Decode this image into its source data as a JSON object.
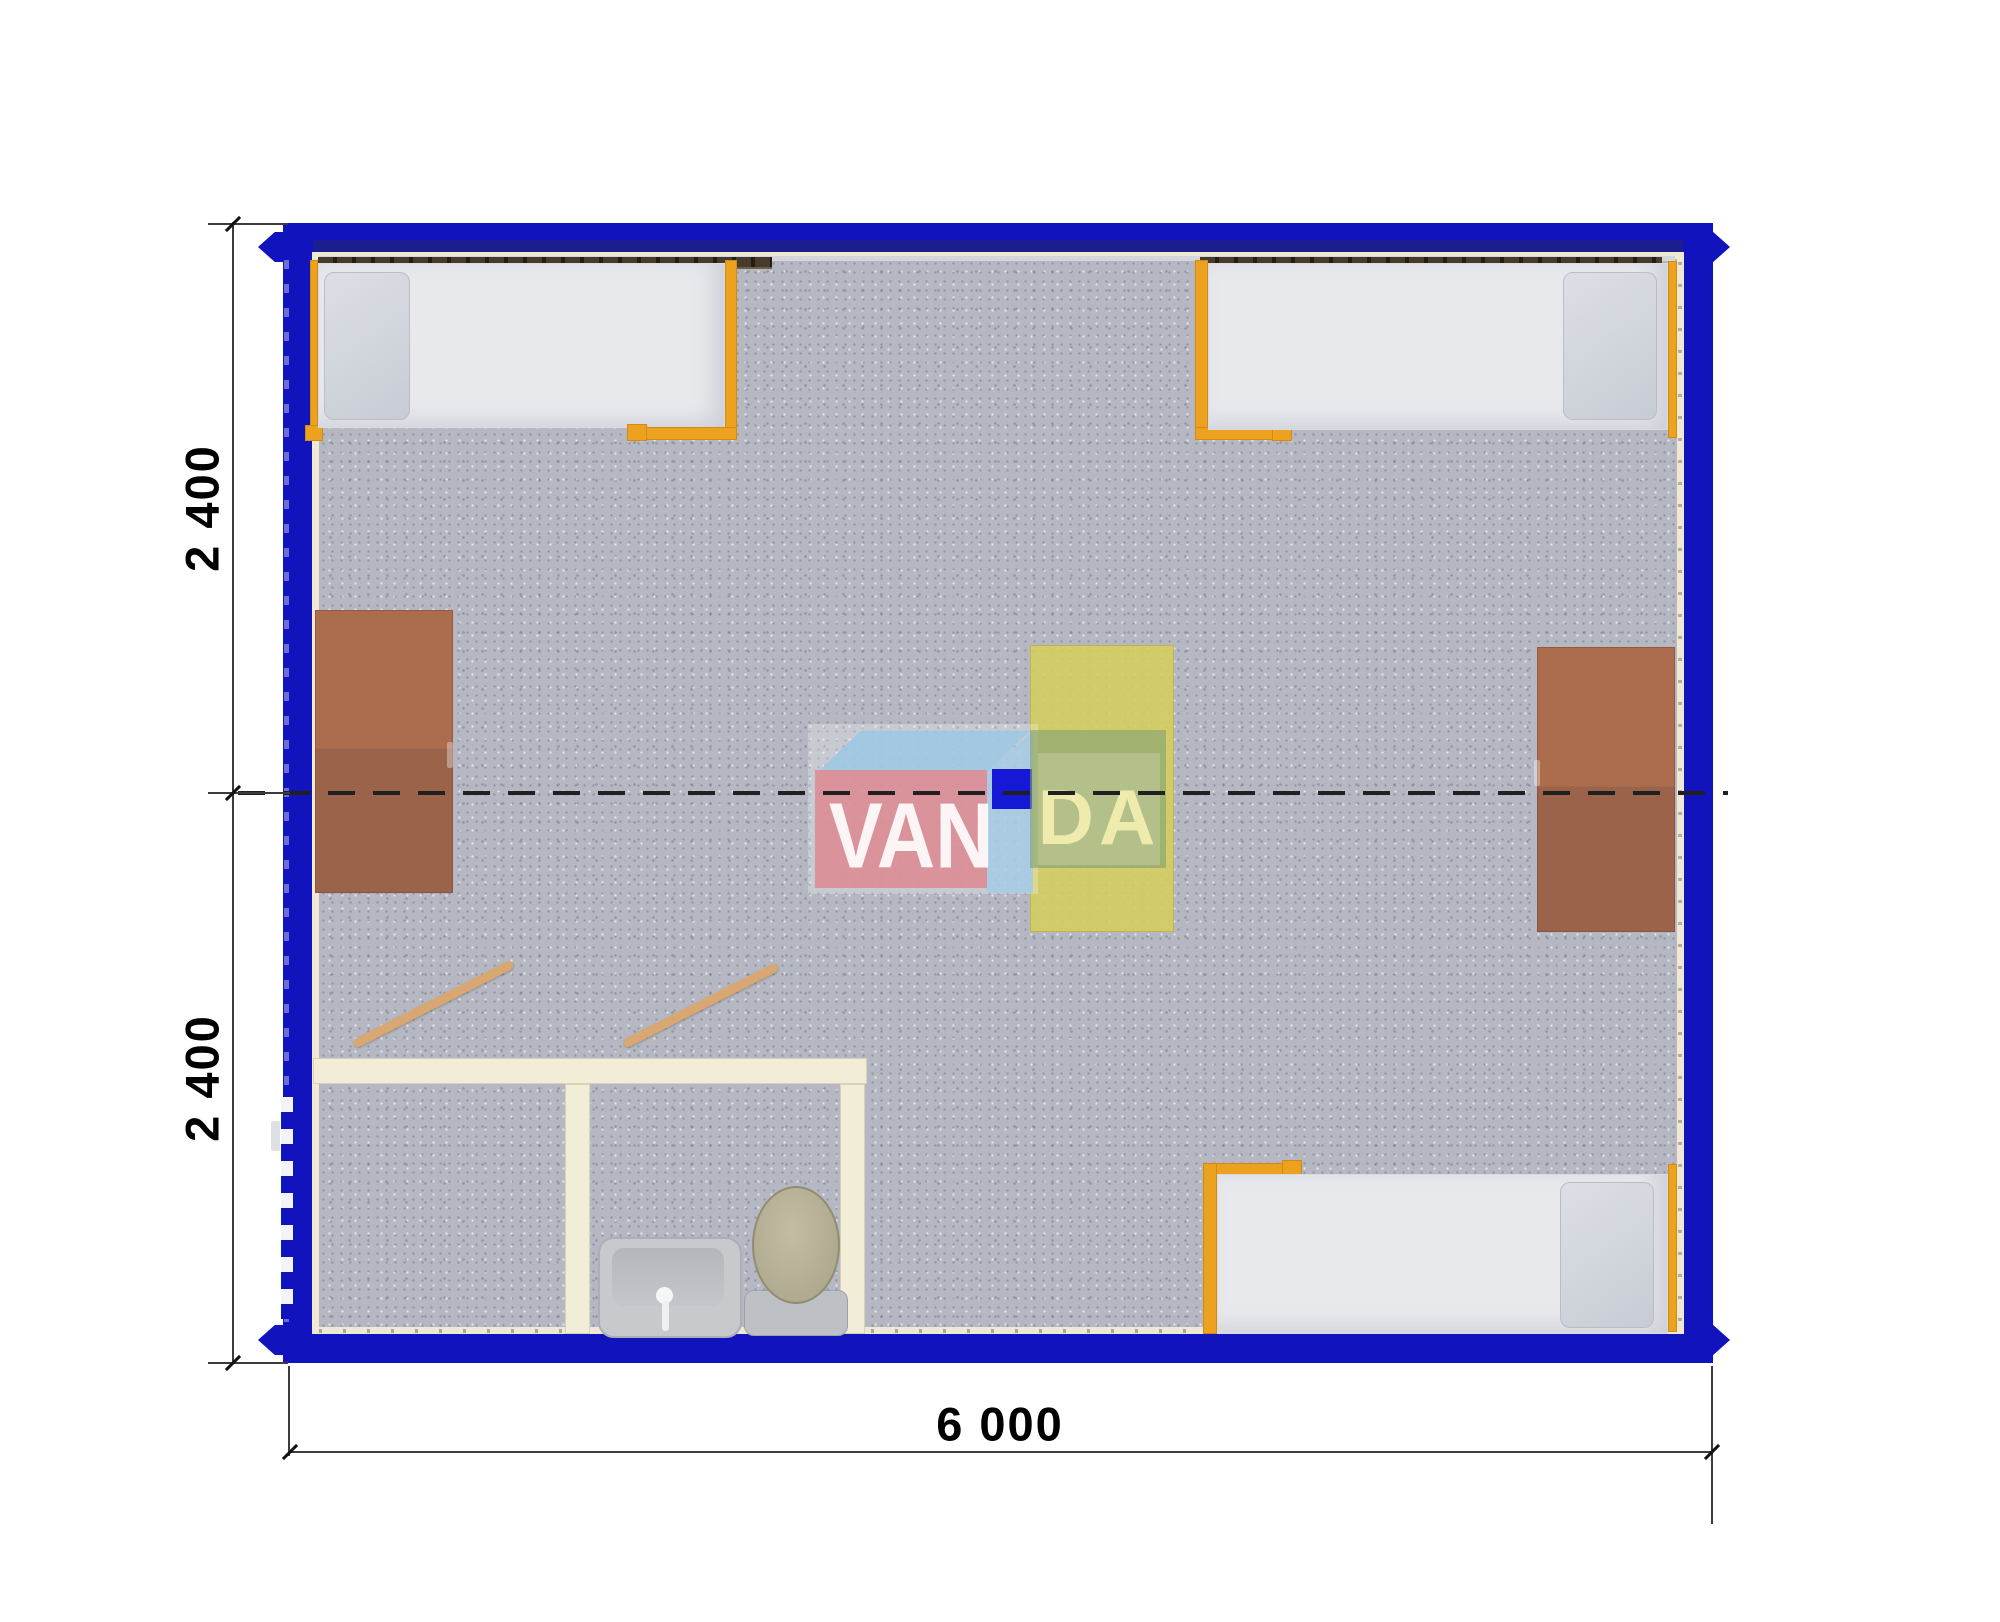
{
  "dimensions": {
    "side_upper": "2 400",
    "side_lower": "2 400",
    "bottom": "6 000"
  },
  "watermark": {
    "left": "VAN",
    "right": "DA"
  },
  "colors": {
    "frame_blue": "#1113bd",
    "bed_frame_orange": "#eda21f",
    "desk_brown": "#a8684c",
    "partition_cream": "#f2edd7",
    "floor_gray": "#b5b8c2",
    "table_yellow": "#d5cd60",
    "logo_pink": "#db8d95",
    "logo_blue": "#1519d6",
    "logo_green": "#82a273"
  },
  "furniture": {
    "beds": [
      "bed-top-left",
      "bed-top-right",
      "bed-bottom-right"
    ],
    "desks": [
      "desk-left",
      "desk-right"
    ],
    "center_table": "table-center",
    "sanitary": [
      "sink",
      "toilet"
    ],
    "doors": [
      "door-room-1",
      "door-room-2"
    ]
  }
}
